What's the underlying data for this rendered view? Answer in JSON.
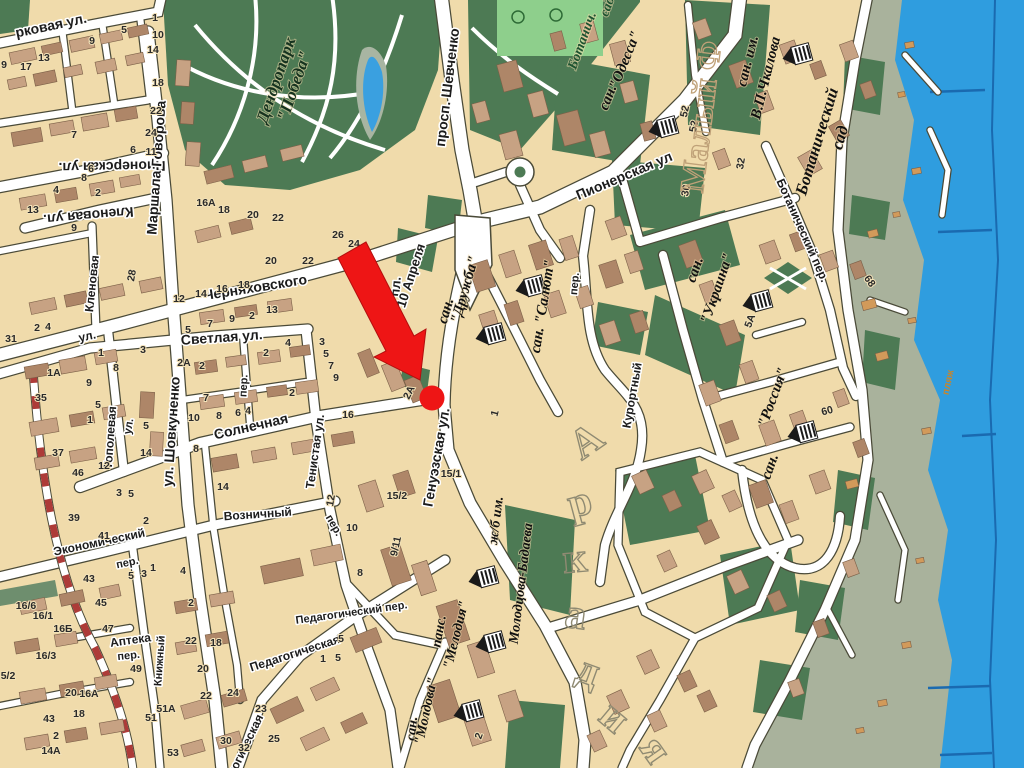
{
  "map": {
    "kind": "city-tourist-map",
    "colors": {
      "sand": "#f0dbab",
      "park_green": "#4d7a54",
      "field_green": "#8ecf8c",
      "coastal": "#a9b29c",
      "sea": "#2f9ddf",
      "sea_line": "#1a6ab0",
      "road": "#ffffff",
      "road_casing": "#4a4a38",
      "building_light": "#c7a283",
      "building_dark": "#ae8668",
      "cabin": "#d29a5a",
      "marker_red": "#ee1515",
      "railway_red": "#ad3b38"
    },
    "streets": [
      {
        "t": "рковая ул.",
        "x": 52,
        "y": 30,
        "r": -12
      },
      {
        "t": "Пионерская ул.",
        "x": 112,
        "y": 162,
        "r": 179
      },
      {
        "t": "Маршала Говорова",
        "x": 161,
        "y": 168,
        "r": -86
      },
      {
        "t": "Кленовая ул.",
        "x": 88,
        "y": 211,
        "r": 175
      },
      {
        "t": "Кленовая",
        "x": 96,
        "y": 284,
        "r": -84,
        "s": 12
      },
      {
        "t": "просп. Шевченко",
        "x": 452,
        "y": 88,
        "r": -83
      },
      {
        "t": "Пионерская  ул",
        "x": 626,
        "y": 180,
        "r": -23
      },
      {
        "t": "ул.",
        "x": 88,
        "y": 340,
        "r": -12,
        "s": 12
      },
      {
        "t": "Черняховского",
        "x": 256,
        "y": 292,
        "r": -9
      },
      {
        "t": "Светлая ул.",
        "x": 222,
        "y": 342,
        "r": -4
      },
      {
        "t": "пер.",
        "x": 247,
        "y": 386,
        "r": -87,
        "s": 11
      },
      {
        "t": "Тополевая",
        "x": 114,
        "y": 438,
        "r": -86,
        "s": 12
      },
      {
        "t": "ул.",
        "x": 132,
        "y": 427,
        "r": -80,
        "s": 11
      },
      {
        "t": "ул. Шовкуненко",
        "x": 176,
        "y": 432,
        "r": -86
      },
      {
        "t": "Солнечная",
        "x": 252,
        "y": 431,
        "r": -13
      },
      {
        "t": "Тенистая ул.",
        "x": 319,
        "y": 452,
        "r": -82,
        "s": 12
      },
      {
        "t": "Генуэзская ул.",
        "x": 441,
        "y": 458,
        "r": -80
      },
      {
        "t": "пл.",
        "x": 400,
        "y": 287,
        "r": -85,
        "s": 13
      },
      {
        "t": "10 Апреля",
        "x": 415,
        "y": 277,
        "r": -72,
        "s": 13
      },
      {
        "t": "пер.",
        "x": 578,
        "y": 284,
        "r": -85,
        "s": 11
      },
      {
        "t": "Курортный",
        "x": 636,
        "y": 396,
        "r": -80,
        "s": 12
      },
      {
        "t": "Ботанический пер.",
        "x": 799,
        "y": 232,
        "r": 66,
        "s": 12
      },
      {
        "t": "Экономический",
        "x": 100,
        "y": 546,
        "r": -12,
        "s": 12
      },
      {
        "t": "пер.",
        "x": 128,
        "y": 566,
        "r": -12,
        "s": 11
      },
      {
        "t": "Возничный",
        "x": 258,
        "y": 518,
        "r": -4,
        "s": 12
      },
      {
        "t": "пер.",
        "x": 331,
        "y": 527,
        "r": 60,
        "s": 11
      },
      {
        "t": "Аптека",
        "x": 131,
        "y": 644,
        "r": -8,
        "s": 12
      },
      {
        "t": "пер.",
        "x": 129,
        "y": 659,
        "r": -6,
        "s": 11
      },
      {
        "t": "Книжный",
        "x": 163,
        "y": 661,
        "r": -86,
        "s": 11
      },
      {
        "t": "Педагогическая",
        "x": 296,
        "y": 657,
        "r": -18,
        "s": 12
      },
      {
        "t": "Педагогический пер.",
        "x": 352,
        "y": 616,
        "r": -8,
        "s": 11
      },
      {
        "t": "Педагогическая",
        "x": 243,
        "y": 759,
        "r": -64,
        "s": 12
      },
      {
        "t": "пляж",
        "x": 951,
        "y": 383,
        "r": -78,
        "s": 10,
        "k": "orange"
      }
    ],
    "places": [
      {
        "t": "Дендропарк",
        "x": 281,
        "y": 82,
        "r": -71,
        "k": "park",
        "s": 17
      },
      {
        "t": "\"Победа\"",
        "x": 299,
        "y": 88,
        "r": -71,
        "k": "park",
        "s": 17
      },
      {
        "t": "Ботанич.",
        "x": 586,
        "y": 42,
        "r": -70,
        "k": "green",
        "s": 14
      },
      {
        "t": "сад",
        "x": 611,
        "y": 8,
        "r": -70,
        "k": "green",
        "s": 14
      },
      {
        "t": "сан.",
        "x": 612,
        "y": 99,
        "r": -68,
        "s": 15
      },
      {
        "t": "\"Одесса\"",
        "x": 629,
        "y": 62,
        "r": -68,
        "s": 15
      },
      {
        "t": "сан. им.",
        "x": 752,
        "y": 62,
        "r": -76,
        "s": 15
      },
      {
        "t": "В.П.Чкалова",
        "x": 770,
        "y": 79,
        "r": -76,
        "s": 15
      },
      {
        "t": "Ботанический",
        "x": 822,
        "y": 143,
        "r": -73,
        "k": "big2",
        "s": 17
      },
      {
        "t": "сад",
        "x": 845,
        "y": 139,
        "r": -73,
        "k": "big2",
        "s": 17
      },
      {
        "t": "сан.",
        "x": 450,
        "y": 312,
        "r": -74,
        "s": 15
      },
      {
        "t": "\"Дружба\"",
        "x": 469,
        "y": 291,
        "r": -74,
        "s": 15
      },
      {
        "t": "сан. \"Салют\"",
        "x": 547,
        "y": 307,
        "r": -81,
        "s": 15
      },
      {
        "t": "сан.",
        "x": 699,
        "y": 271,
        "r": -71,
        "s": 15
      },
      {
        "t": "\"Украина\"",
        "x": 721,
        "y": 290,
        "r": -71,
        "s": 15
      },
      {
        "t": "\"Россия\"",
        "x": 777,
        "y": 399,
        "r": -70,
        "s": 15
      },
      {
        "t": "сан.",
        "x": 774,
        "y": 468,
        "r": -70,
        "s": 15
      },
      {
        "t": "сан.",
        "x": 416,
        "y": 729,
        "r": -84,
        "s": 14
      },
      {
        "t": "\"Молдова\"",
        "x": 430,
        "y": 712,
        "r": -78,
        "s": 14
      },
      {
        "t": "панс.",
        "x": 443,
        "y": 632,
        "r": -80,
        "s": 14
      },
      {
        "t": "\"Мелодия\"",
        "x": 460,
        "y": 636,
        "r": -76,
        "s": 14
      },
      {
        "t": "ж/б  им.",
        "x": 500,
        "y": 521,
        "r": -83,
        "s": 14
      },
      {
        "t": "Молодцова-Бадаева",
        "x": 525,
        "y": 584,
        "r": -83,
        "s": 14
      }
    ],
    "districts": [
      {
        "text": "Аркадия"
      },
      {
        "text": "Малый Ф"
      }
    ],
    "house_numbers": [
      {
        "t": "9",
        "x": 4,
        "y": 68
      },
      {
        "t": "17",
        "x": 26,
        "y": 70
      },
      {
        "t": "13",
        "x": 44,
        "y": 61
      },
      {
        "t": "9",
        "x": 92,
        "y": 44
      },
      {
        "t": "5",
        "x": 124,
        "y": 33
      },
      {
        "t": "1",
        "x": 155,
        "y": 21
      },
      {
        "t": "10",
        "x": 158,
        "y": 38
      },
      {
        "t": "14",
        "x": 153,
        "y": 53
      },
      {
        "t": "18",
        "x": 158,
        "y": 86
      },
      {
        "t": "22",
        "x": 156,
        "y": 114
      },
      {
        "t": "24",
        "x": 151,
        "y": 136
      },
      {
        "t": "11",
        "x": 151,
        "y": 155
      },
      {
        "t": "6",
        "x": 133,
        "y": 153
      },
      {
        "t": "7",
        "x": 74,
        "y": 138
      },
      {
        "t": "6",
        "x": 91,
        "y": 172
      },
      {
        "t": "8",
        "x": 84,
        "y": 181
      },
      {
        "t": "2",
        "x": 98,
        "y": 196
      },
      {
        "t": "4",
        "x": 56,
        "y": 193
      },
      {
        "t": "13",
        "x": 33,
        "y": 213
      },
      {
        "t": "9",
        "x": 74,
        "y": 231
      },
      {
        "t": "16А",
        "x": 206,
        "y": 206
      },
      {
        "t": "18",
        "x": 224,
        "y": 213
      },
      {
        "t": "20",
        "x": 253,
        "y": 218
      },
      {
        "t": "22",
        "x": 278,
        "y": 221
      },
      {
        "t": "26",
        "x": 338,
        "y": 238
      },
      {
        "t": "24",
        "x": 354,
        "y": 247
      },
      {
        "t": "28",
        "x": 135,
        "y": 276,
        "r": -80
      },
      {
        "t": "12",
        "x": 179,
        "y": 302
      },
      {
        "t": "14",
        "x": 201,
        "y": 297
      },
      {
        "t": "16",
        "x": 222,
        "y": 292
      },
      {
        "t": "18",
        "x": 244,
        "y": 288
      },
      {
        "t": "20",
        "x": 271,
        "y": 264
      },
      {
        "t": "22",
        "x": 308,
        "y": 264
      },
      {
        "t": "5",
        "x": 188,
        "y": 333
      },
      {
        "t": "7",
        "x": 210,
        "y": 327
      },
      {
        "t": "9",
        "x": 232,
        "y": 322
      },
      {
        "t": "2",
        "x": 252,
        "y": 319
      },
      {
        "t": "13",
        "x": 272,
        "y": 313
      },
      {
        "t": "31",
        "x": 11,
        "y": 342
      },
      {
        "t": "2",
        "x": 37,
        "y": 331
      },
      {
        "t": "4",
        "x": 48,
        "y": 330
      },
      {
        "t": "1",
        "x": 101,
        "y": 356
      },
      {
        "t": "3",
        "x": 143,
        "y": 353
      },
      {
        "t": "8",
        "x": 116,
        "y": 371
      },
      {
        "t": "1А",
        "x": 54,
        "y": 376
      },
      {
        "t": "9",
        "x": 89,
        "y": 386
      },
      {
        "t": "35",
        "x": 41,
        "y": 401
      },
      {
        "t": "1",
        "x": 90,
        "y": 423
      },
      {
        "t": "5",
        "x": 98,
        "y": 408
      },
      {
        "t": "37",
        "x": 58,
        "y": 456
      },
      {
        "t": "46",
        "x": 78,
        "y": 476
      },
      {
        "t": "12",
        "x": 104,
        "y": 469
      },
      {
        "t": "5",
        "x": 146,
        "y": 429
      },
      {
        "t": "14",
        "x": 146,
        "y": 456
      },
      {
        "t": "3",
        "x": 119,
        "y": 496
      },
      {
        "t": "5",
        "x": 131,
        "y": 497
      },
      {
        "t": "2А",
        "x": 184,
        "y": 366
      },
      {
        "t": "2",
        "x": 202,
        "y": 369
      },
      {
        "t": "7",
        "x": 206,
        "y": 401
      },
      {
        "t": "10",
        "x": 194,
        "y": 421
      },
      {
        "t": "8",
        "x": 219,
        "y": 419
      },
      {
        "t": "6",
        "x": 238,
        "y": 416
      },
      {
        "t": "4",
        "x": 248,
        "y": 414
      },
      {
        "t": "2",
        "x": 292,
        "y": 396
      },
      {
        "t": "2",
        "x": 266,
        "y": 356
      },
      {
        "t": "4",
        "x": 288,
        "y": 346
      },
      {
        "t": "3",
        "x": 322,
        "y": 345
      },
      {
        "t": "5",
        "x": 326,
        "y": 357
      },
      {
        "t": "7",
        "x": 331,
        "y": 369
      },
      {
        "t": "9",
        "x": 336,
        "y": 381
      },
      {
        "t": "16",
        "x": 348,
        "y": 418
      },
      {
        "t": "2А",
        "x": 412,
        "y": 394,
        "r": -64
      },
      {
        "t": "1",
        "x": 498,
        "y": 414,
        "r": -75
      },
      {
        "t": "8",
        "x": 196,
        "y": 452
      },
      {
        "t": "14",
        "x": 223,
        "y": 490
      },
      {
        "t": "15/1",
        "x": 451,
        "y": 477
      },
      {
        "t": "15/2",
        "x": 397,
        "y": 499
      },
      {
        "t": "12",
        "x": 334,
        "y": 501,
        "r": -80
      },
      {
        "t": "9/11",
        "x": 399,
        "y": 547,
        "r": -78
      },
      {
        "t": "10",
        "x": 352,
        "y": 531
      },
      {
        "t": "8",
        "x": 360,
        "y": 576
      },
      {
        "t": "5",
        "x": 341,
        "y": 642
      },
      {
        "t": "2",
        "x": 482,
        "y": 737,
        "r": -70
      },
      {
        "t": "39",
        "x": 74,
        "y": 521
      },
      {
        "t": "41",
        "x": 104,
        "y": 539
      },
      {
        "t": "2",
        "x": 146,
        "y": 524
      },
      {
        "t": "43",
        "x": 89,
        "y": 582
      },
      {
        "t": "45",
        "x": 101,
        "y": 606
      },
      {
        "t": "47",
        "x": 108,
        "y": 632
      },
      {
        "t": "5",
        "x": 131,
        "y": 579
      },
      {
        "t": "3",
        "x": 144,
        "y": 577
      },
      {
        "t": "1",
        "x": 153,
        "y": 571
      },
      {
        "t": "4",
        "x": 183,
        "y": 574
      },
      {
        "t": "2",
        "x": 191,
        "y": 606
      },
      {
        "t": "22",
        "x": 191,
        "y": 644
      },
      {
        "t": "18",
        "x": 216,
        "y": 646
      },
      {
        "t": "20",
        "x": 203,
        "y": 672
      },
      {
        "t": "22",
        "x": 206,
        "y": 699
      },
      {
        "t": "24",
        "x": 233,
        "y": 696
      },
      {
        "t": "49",
        "x": 136,
        "y": 672
      },
      {
        "t": "51А",
        "x": 166,
        "y": 712
      },
      {
        "t": "51",
        "x": 151,
        "y": 721
      },
      {
        "t": "53",
        "x": 173,
        "y": 756
      },
      {
        "t": "16/6",
        "x": 26,
        "y": 609
      },
      {
        "t": "16/1",
        "x": 43,
        "y": 619
      },
      {
        "t": "16Б",
        "x": 63,
        "y": 632
      },
      {
        "t": "16/3",
        "x": 46,
        "y": 659
      },
      {
        "t": "5/2",
        "x": 8,
        "y": 679
      },
      {
        "t": "20",
        "x": 71,
        "y": 696
      },
      {
        "t": "16А",
        "x": 89,
        "y": 697
      },
      {
        "t": "18",
        "x": 79,
        "y": 717
      },
      {
        "t": "43",
        "x": 49,
        "y": 722
      },
      {
        "t": "2",
        "x": 56,
        "y": 739
      },
      {
        "t": "14А",
        "x": 51,
        "y": 754
      },
      {
        "t": "30",
        "x": 226,
        "y": 744
      },
      {
        "t": "32",
        "x": 244,
        "y": 751
      },
      {
        "t": "23",
        "x": 261,
        "y": 712
      },
      {
        "t": "25",
        "x": 274,
        "y": 742
      },
      {
        "t": "1",
        "x": 323,
        "y": 662
      },
      {
        "t": "5",
        "x": 338,
        "y": 661
      },
      {
        "t": "52",
        "x": 688,
        "y": 112,
        "r": -78
      },
      {
        "t": "52",
        "x": 697,
        "y": 127,
        "r": -78
      },
      {
        "t": "32",
        "x": 744,
        "y": 164,
        "r": -80
      },
      {
        "t": "30",
        "x": 689,
        "y": 191,
        "r": -80
      },
      {
        "t": "68",
        "x": 867,
        "y": 283,
        "r": 55
      },
      {
        "t": "60",
        "x": 828,
        "y": 414,
        "r": -15
      },
      {
        "t": "5А",
        "x": 753,
        "y": 322,
        "r": -70
      }
    ],
    "markers": {
      "destination_arrow": {
        "name": "red-arrow-marker",
        "tip_x": 420,
        "tip_y": 380,
        "color": "#ee1515"
      },
      "destination_dot": {
        "name": "red-dot-marker",
        "x": 432,
        "y": 398,
        "radius": 12.5,
        "color": "#ee1515"
      },
      "classical_building_icons": [
        [
          490,
          335
        ],
        [
          530,
          287
        ],
        [
          663,
          128
        ],
        [
          797,
          55
        ],
        [
          757,
          302
        ],
        [
          802,
          433
        ],
        [
          483,
          578
        ],
        [
          490,
          643
        ],
        [
          468,
          712
        ]
      ]
    }
  }
}
